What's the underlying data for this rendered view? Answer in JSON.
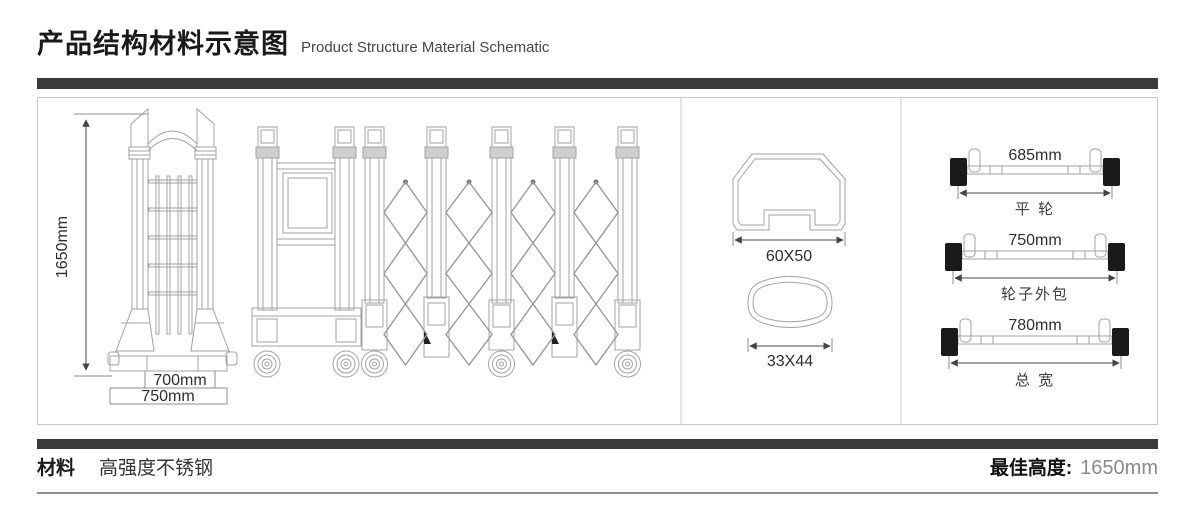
{
  "header": {
    "title": "产品结构材料示意图",
    "subtitle": "Product Structure Material Schematic"
  },
  "gate_view": {
    "height": "1650mm",
    "inner_width": "700mm",
    "outer_width": "750mm"
  },
  "profiles": {
    "large_label": "60X50",
    "small_label": "33X44"
  },
  "axles": {
    "flat_wheel": {
      "dimension": "685mm",
      "label": "平 轮"
    },
    "wheel_wrap": {
      "dimension": "750mm",
      "label": "轮子外包"
    },
    "total_width": {
      "dimension": "780mm",
      "label": "总 宽"
    }
  },
  "footer": {
    "material_label": "材料",
    "material_value": "高强度不锈钢",
    "best_height_label": "最佳高度:",
    "best_height_value": "1650mm"
  },
  "colors": {
    "bar": "#3b3b3b",
    "panel_border": "#c9c9c9",
    "drawing_line": "#a3a3a3",
    "dimension_text": "#2e2e2e",
    "muted_value": "#8a8a8a"
  }
}
